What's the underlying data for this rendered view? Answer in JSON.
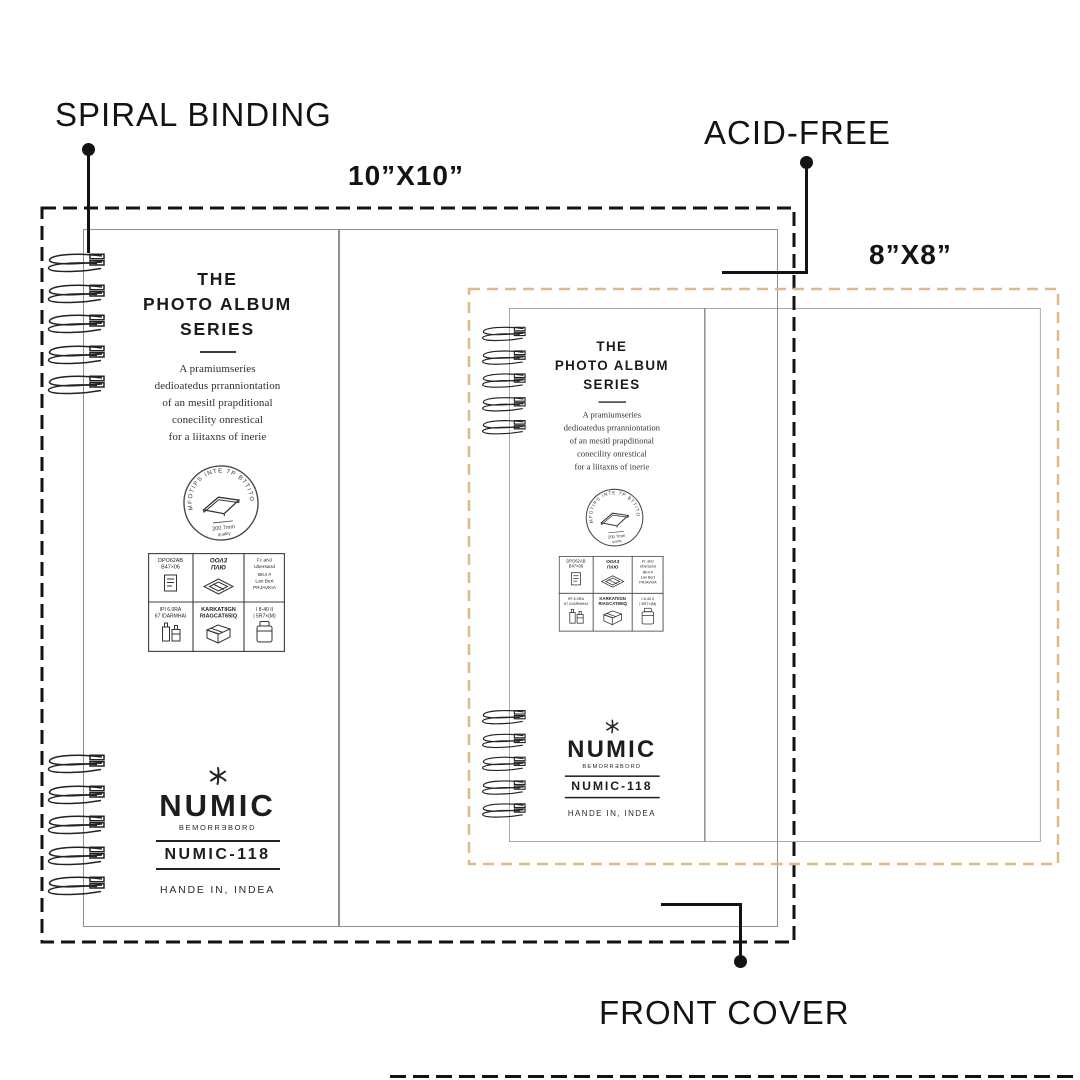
{
  "annotations": {
    "spiral_binding": "SPIRAL BINDING",
    "acid_free": "ACID-FREE",
    "front_cover": "FRONT COVER",
    "size_large": "10”X10”",
    "size_small": "8”X8”"
  },
  "album": {
    "series_lines": [
      "THE",
      "PHOTO ALBUM",
      "SERIES"
    ],
    "description": [
      "A pramiumseries",
      "dedioatedus prranniontation",
      "of an mesitl prapditional",
      "conecility onrestical",
      "for a liitaxns of inerie"
    ],
    "stamp": {
      "arc_text": "MFOTIPS INTE 7P BTTITO",
      "caption1": "200 7mm",
      "caption2": "quality"
    },
    "spec_grid": {
      "cells": [
        {
          "icon": "document-icon",
          "lines": [
            "DPO62AB",
            "B47×06"
          ]
        },
        {
          "icon": "diamond-plate-icon",
          "lines": [
            "OOΛ3",
            "ПΛЮ"
          ]
        },
        {
          "icon": "",
          "lines": [
            "Fi: aNJ",
            "Ubersand",
            "BK4 #",
            "Lan Bert",
            "PRJAVKIA"
          ]
        },
        {
          "icon": "bottles-icon",
          "lines": [
            "IPI 6.0RA",
            "67 IDARMHAI"
          ]
        },
        {
          "icon": "carton-box-icon",
          "lines": [
            "KARKATIIGN",
            "RIAGCAT65IQ"
          ]
        },
        {
          "icon": "jar-icon",
          "lines": [
            "I 8-40 II",
            "| 5R7×(M)"
          ]
        }
      ]
    },
    "brand": {
      "mark_icon": "asterisk-flower",
      "name": "NUMIC",
      "subtitle": "BEMORRƎBORD",
      "model": "NUMIC-118",
      "origin": "HANDE IN, INDEA"
    }
  },
  "colors": {
    "frame_dark": "#131313",
    "frame_tan": "#dfb98c",
    "album_outline": "#8f8f8f",
    "ink": "#222222"
  }
}
